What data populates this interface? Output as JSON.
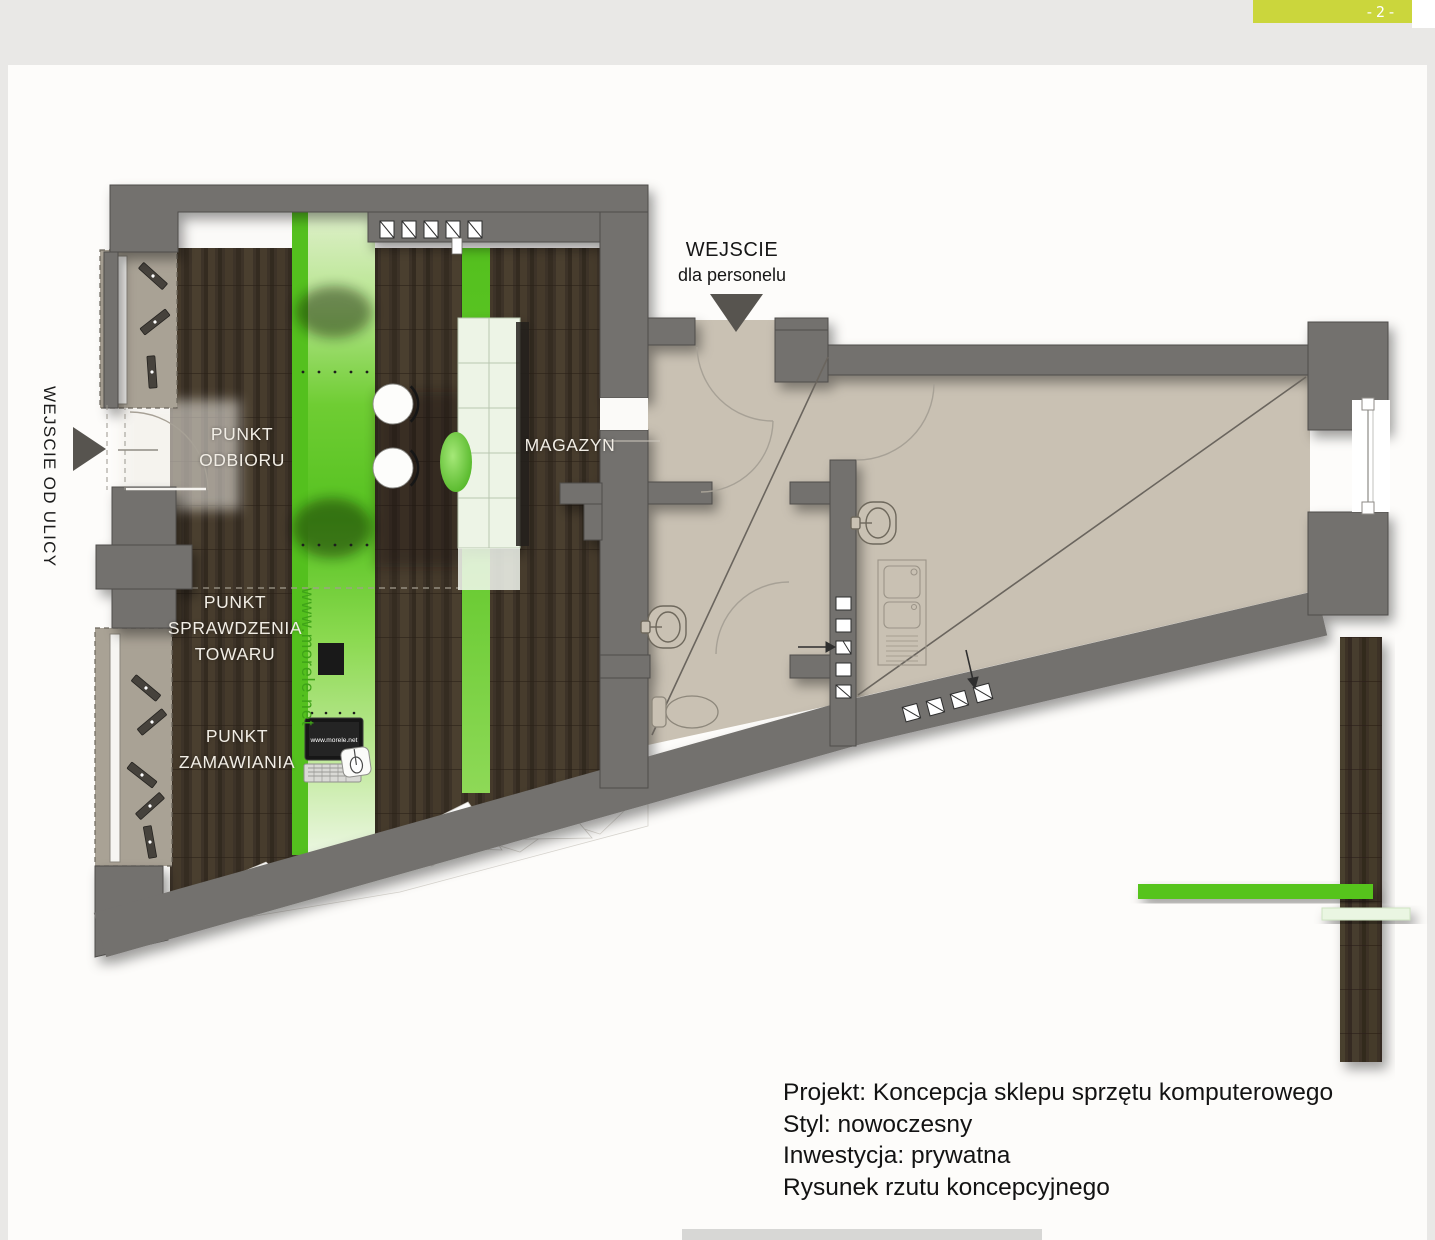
{
  "header": {
    "page_number": "-2-"
  },
  "annotations": {
    "staff_entrance_line1": "WEJSCIE",
    "staff_entrance_line2": "dla personelu",
    "street_entrance": "WEJSCIE OD ULICY"
  },
  "rooms": {
    "pickup_point": "PUNKT\nODBIORU",
    "check_point": "PUNKT\nSPRAWDZENIA\nTOWARU",
    "order_point": "PUNKT\nZAMAWIANIA",
    "storage": "MAGAZYN"
  },
  "branding": {
    "counter_vertical_label": "www.morele.net",
    "screen_label": "www.morele.net"
  },
  "project_info": {
    "line1": "Projekt: Koncepcja sklepu sprzętu komputerowego",
    "line2": "Styl: nowoczesny",
    "line3": "Inwestycja: prywatna",
    "line4": "Rysunek rzutu koncepcyjnego"
  },
  "colors": {
    "accent_green": "#5ec32a",
    "pale_green": "#e9f5de",
    "page_tab_yellow": "#cbd63c",
    "wall_gray": "#73716e",
    "wood_brown": "#3d3328",
    "floor_beige": "#c9c1b3"
  }
}
